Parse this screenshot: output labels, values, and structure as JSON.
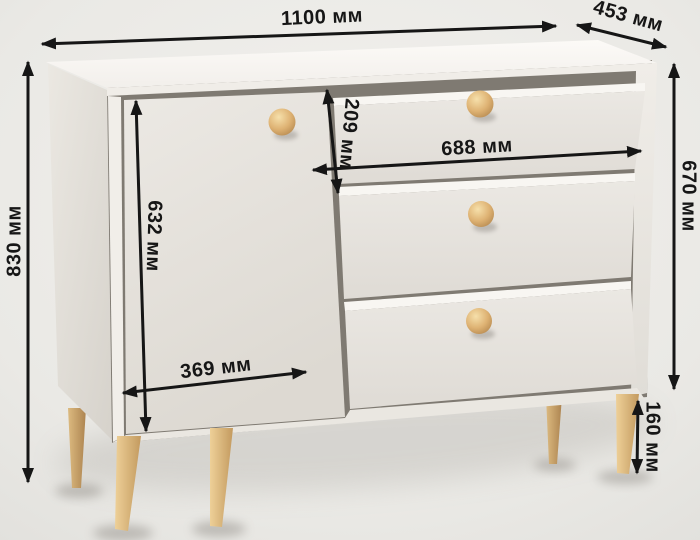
{
  "type": "product-dimension-diagram",
  "product": "chest-of-drawers",
  "unit": "мм",
  "dimensions": {
    "overall_width": "1100 мм",
    "depth": "453 мм",
    "overall_height": "830 мм",
    "body_height": "670 мм",
    "drawer_front_height": "209 мм",
    "drawer_inner_width": "688 мм",
    "door_height": "632 мм",
    "door_width": "369 мм",
    "leg_height": "160 мм"
  },
  "colors": {
    "background": "#eceae7",
    "annotation": "#161616",
    "body_top": "#f9f7f3",
    "body_front": "#e7e4de",
    "carcass_gap": "#7f7a72",
    "wood_knob": "#ddb172",
    "wood_leg": "#d5ac6f"
  }
}
